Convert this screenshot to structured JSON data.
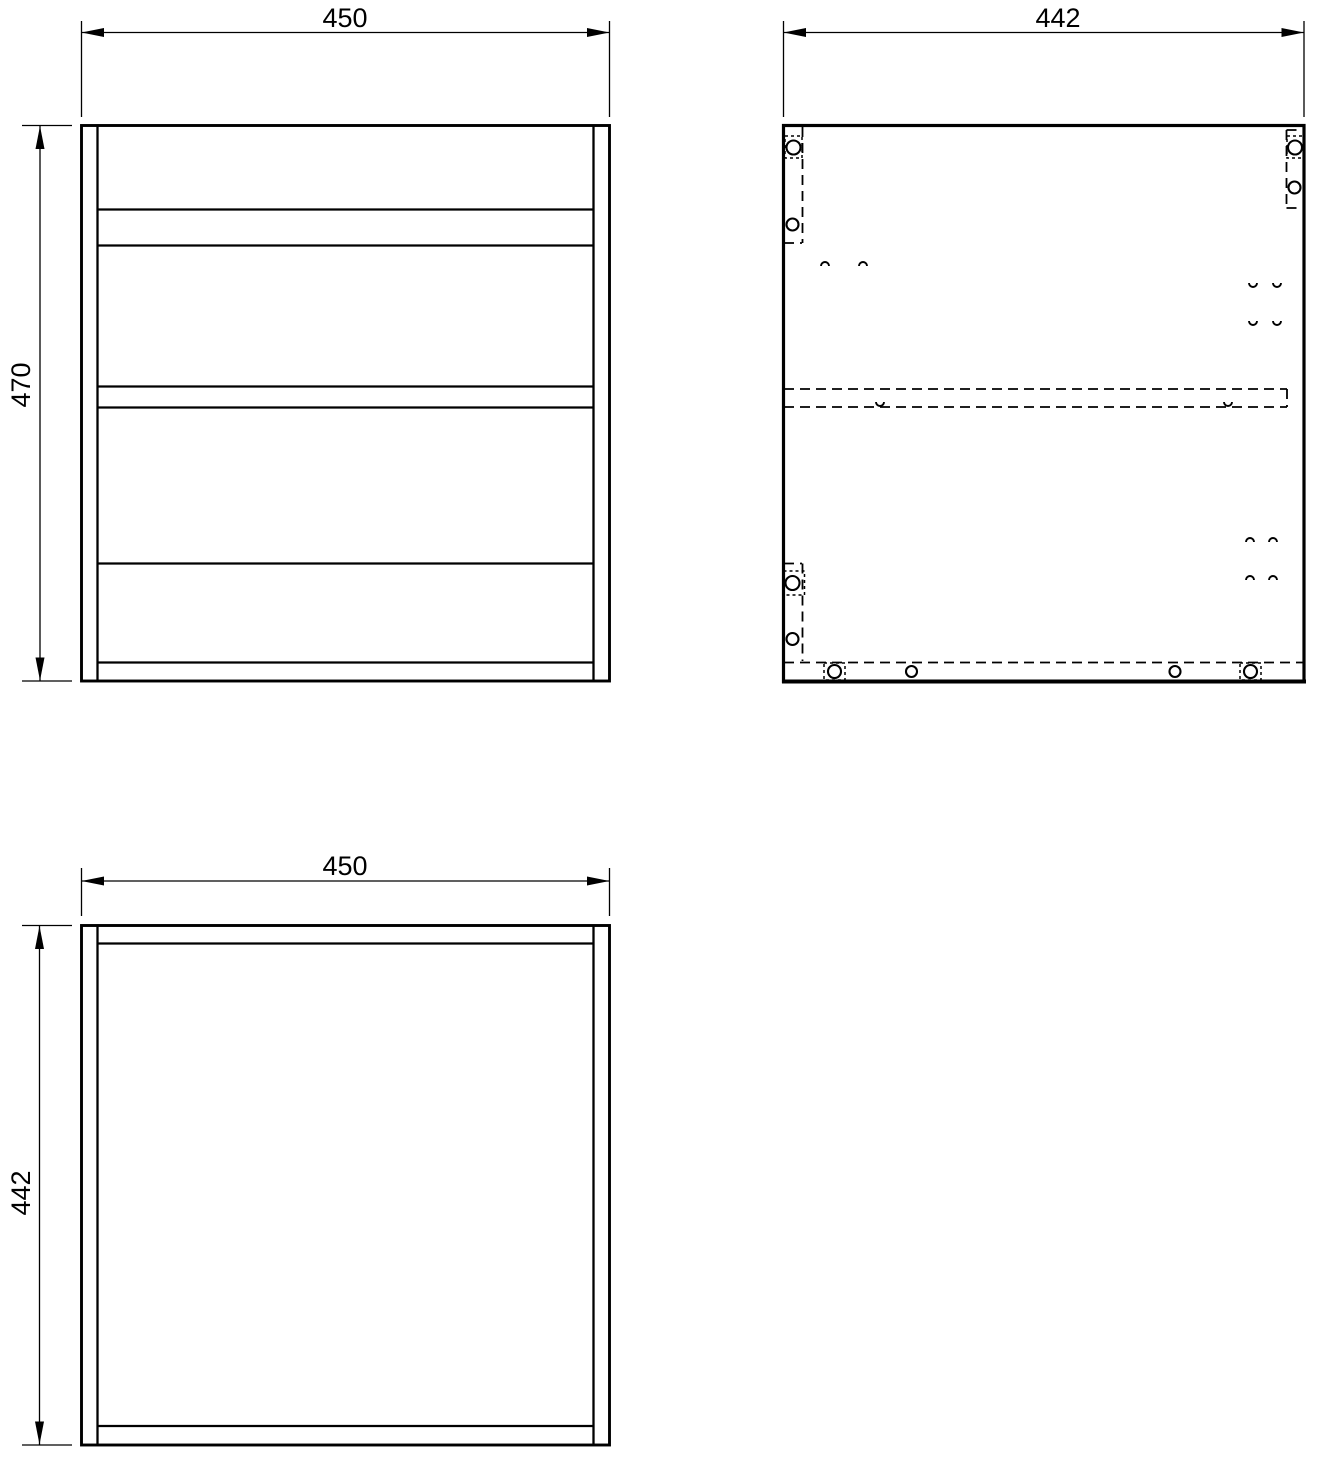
{
  "colors": {
    "line": "#000000",
    "background": "#ffffff"
  },
  "dimensions": {
    "front_width": "450",
    "front_height": "470",
    "side_depth": "442",
    "top_width": "450",
    "top_depth": "442"
  }
}
